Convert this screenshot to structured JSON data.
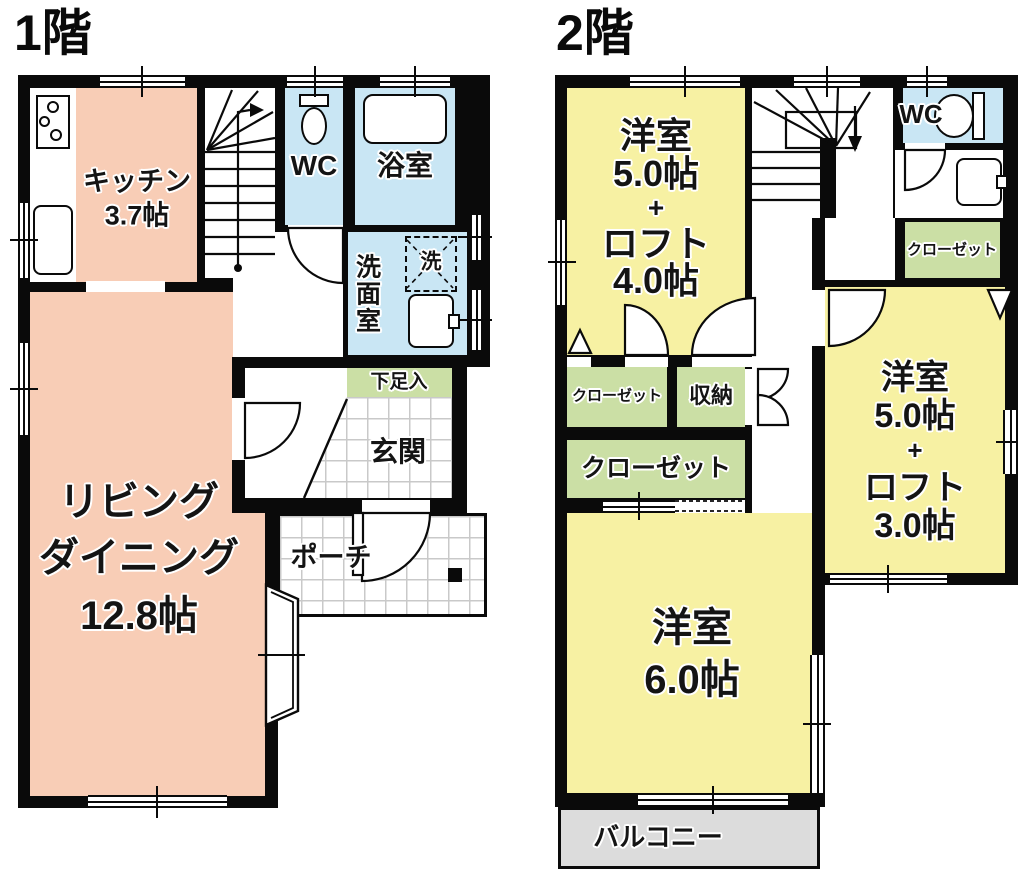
{
  "f1": {
    "title": "1階",
    "kitchen": {
      "name": "キッチン",
      "size": "3.7帖"
    },
    "wc": "WC",
    "bath": "浴室",
    "washroom": "洗面室",
    "washer": "洗",
    "shoe": "下足入",
    "genkan": "玄関",
    "living": {
      "l1": "リビング",
      "l2": "ダイニング",
      "size": "12.8帖"
    },
    "porch": "ポーチ"
  },
  "f2": {
    "title": "2階",
    "room1": {
      "name": "洋室",
      "size": "5.0帖",
      "plus": "+",
      "loft": "ロフト",
      "loftsize": "4.0帖"
    },
    "wc": "WC",
    "closet_right": "クローゼット",
    "room2": {
      "name": "洋室",
      "size": "5.0帖",
      "plus": "+",
      "loft": "ロフト",
      "loftsize": "3.0帖"
    },
    "closet_a": "クローゼット",
    "storage": "収納",
    "closet_b": "クローゼット",
    "room3": {
      "name": "洋室",
      "size": "6.0帖"
    },
    "balcony": "バルコニー"
  },
  "colors": {
    "wall": "#0a0a0a",
    "living_kitchen": "#f8cdb6",
    "bedroom_yellow": "#f7f1a3",
    "closet_green": "#cbdfa5",
    "wet_area_blue": "#c9e6f4",
    "balcony_gray": "#dcdcdc",
    "tile_line": "#c9c9c9"
  }
}
